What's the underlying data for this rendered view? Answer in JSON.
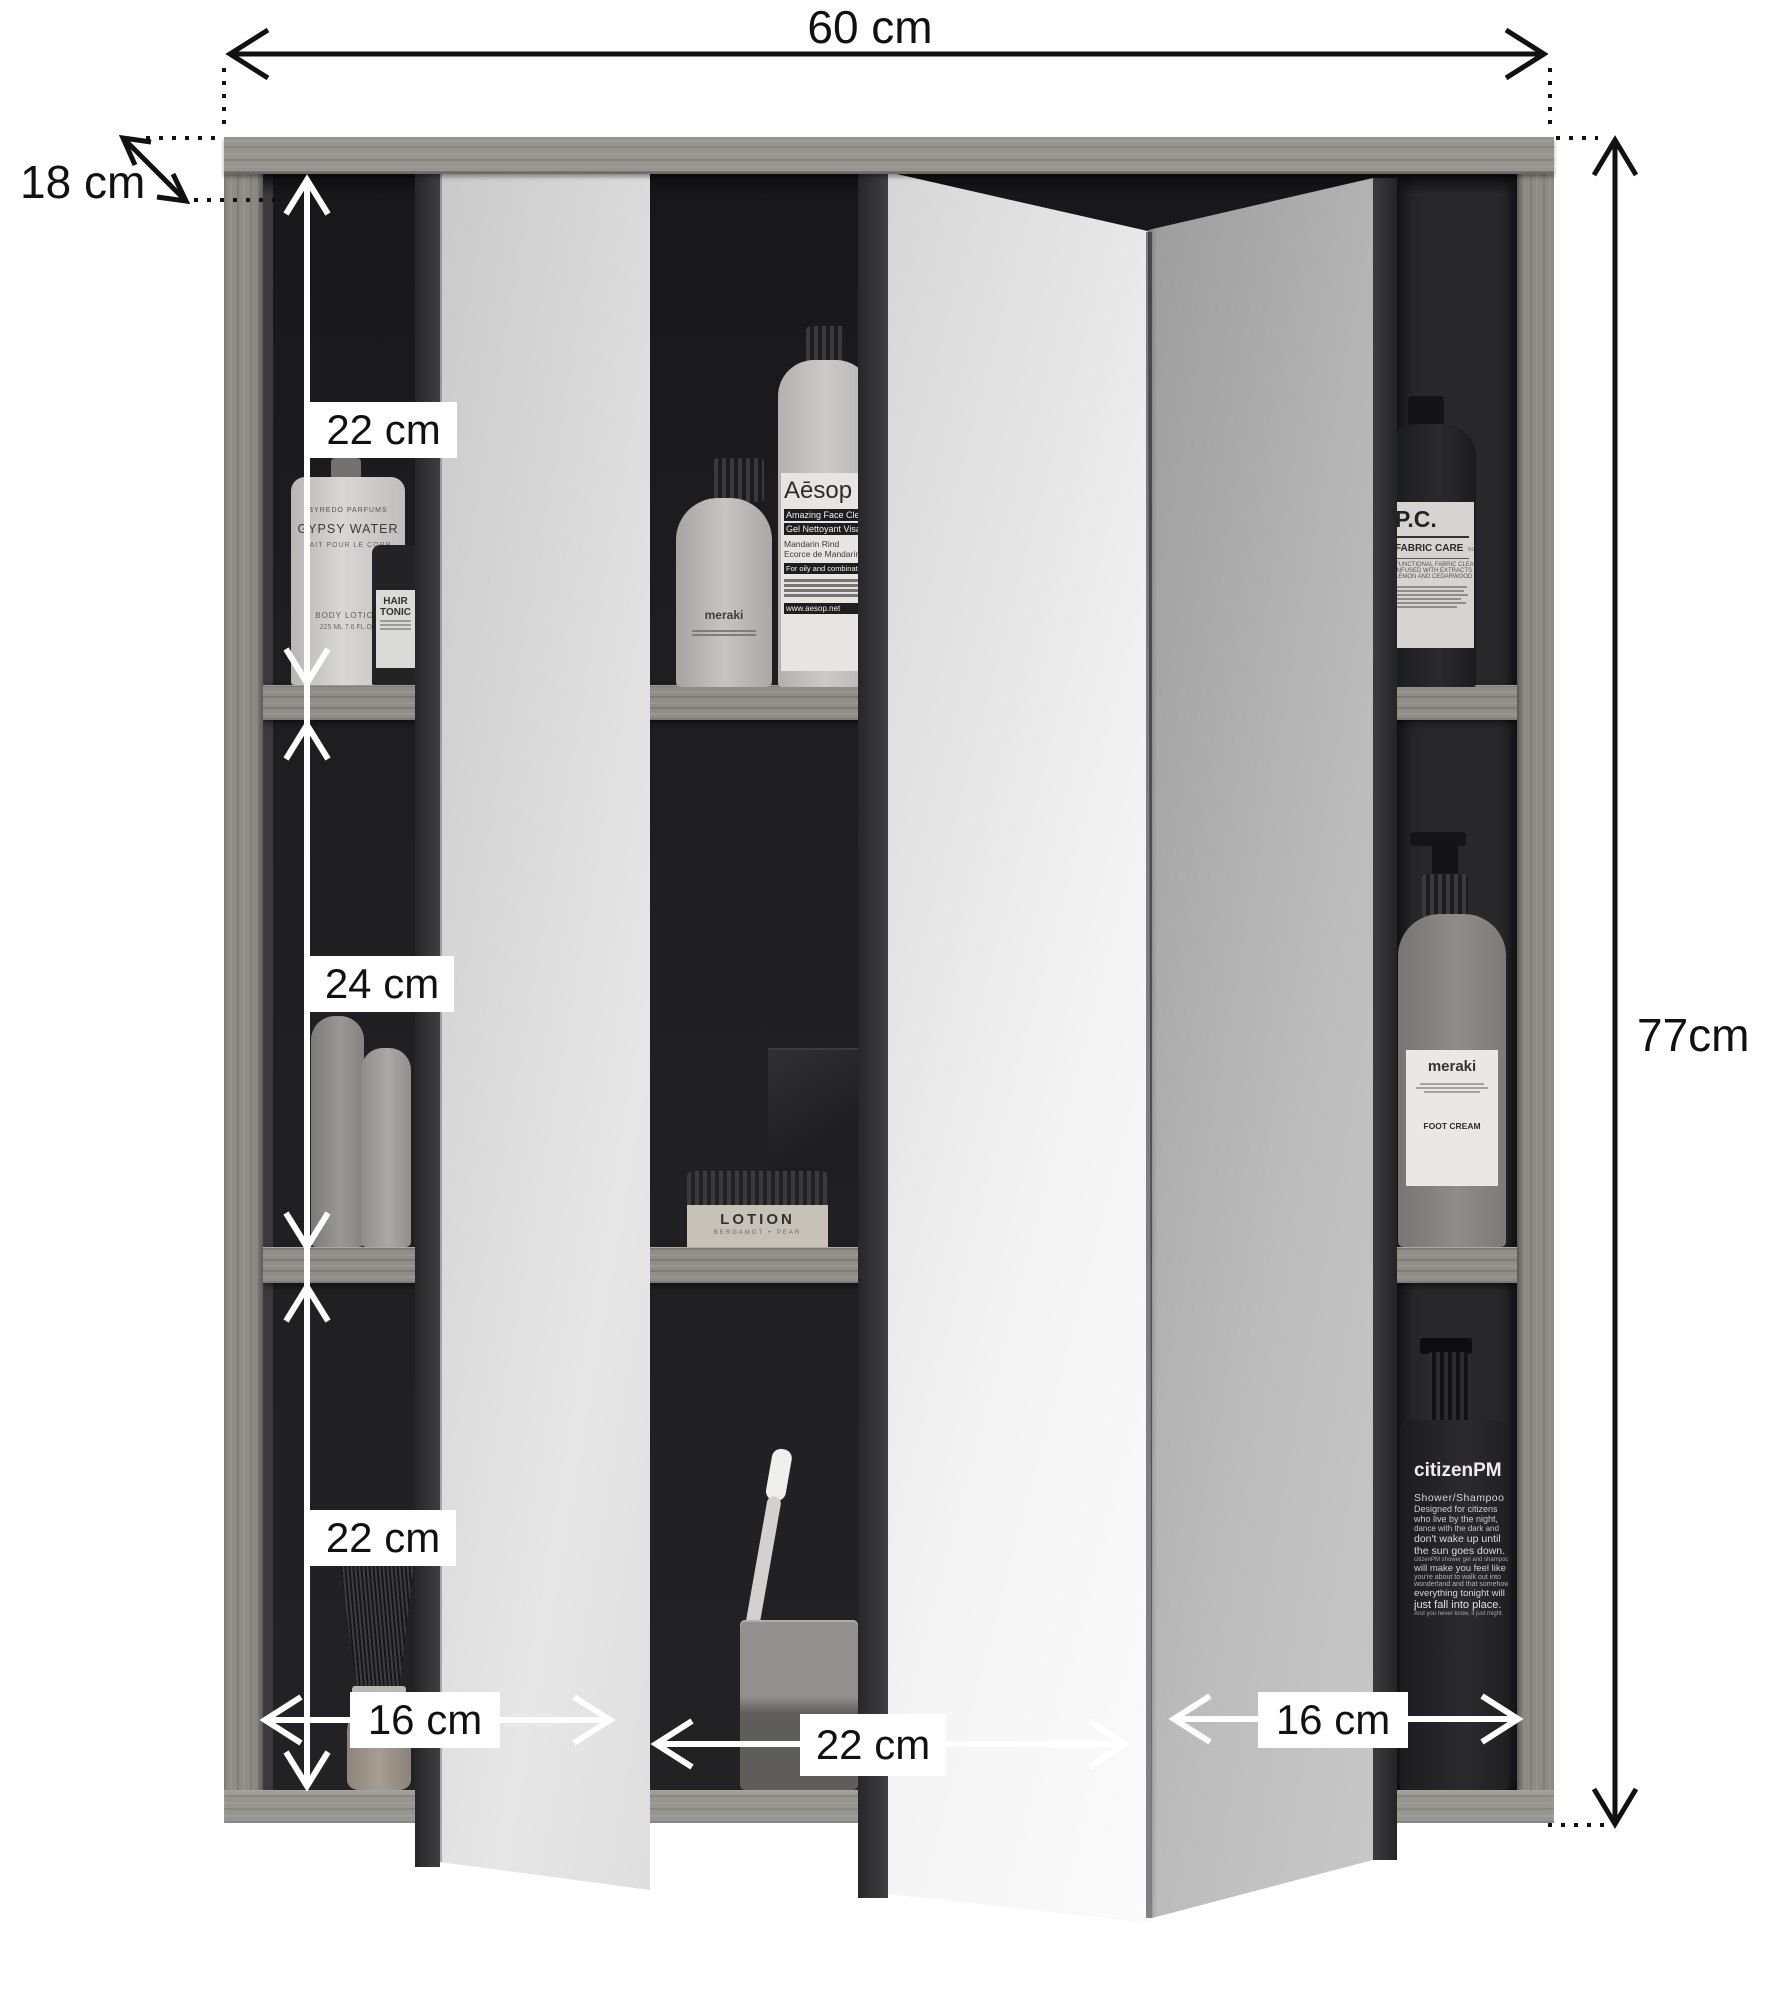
{
  "palette": {
    "wood": "#8e8d89",
    "interior_dark": "#1d1d1f",
    "mirror_light": "#ececec",
    "annotation_black": "#111111",
    "annotation_white": "#ffffff"
  },
  "dimensions": {
    "width": "60 cm",
    "depth": "18 cm",
    "height": "77cm",
    "shelf_heights": [
      "22 cm",
      "24 cm",
      "22 cm"
    ],
    "compartment_widths": [
      "16 cm",
      "22 cm",
      "16 cm"
    ]
  },
  "products": {
    "byredo": {
      "brand": "BYREDO PARFUMS",
      "name": "GYPSY WATER",
      "subtitle": "LAIT POUR LE CORP",
      "type": "BODY LOTION",
      "volume": "225 ML 7.6 FL.OZ"
    },
    "hair_tonic": {
      "line1": "HAIR",
      "line2": "TONIC"
    },
    "meraki_dropper": {
      "brand": "meraki"
    },
    "aesop": {
      "brand": "Aēsop",
      "lines": [
        "Amazing Face Cleanser",
        "Gel Nettoyant Visage",
        "Mandarin Rind",
        "Ecorce de Mandarine",
        "For oily and combination skin"
      ],
      "footer": "www.aesop.net"
    },
    "lotion": {
      "name": "LOTION",
      "subtitle": "BERGAMOT + PEAR"
    },
    "pc": {
      "brand": "P.C.",
      "category": "FABRIC CARE",
      "note": "NET WT 1 GAL",
      "lines": [
        "FUNCTIONAL FABRIC CLEANSER",
        "INFUSED WITH EXTRACTS OF",
        "LEMON AND CEDARWOOD"
      ]
    },
    "meraki_pump": {
      "brand": "meraki",
      "product": "FOOT CREAM"
    },
    "citizen": {
      "brand": "citizenPM",
      "category": "Shower/Shampoo",
      "lines": [
        "Designed for citizens",
        "who live by the night,",
        "dance with the dark and",
        "don't wake up until",
        "the sun goes down.",
        "citizenPM shower gel and shampoo",
        "will make you feel like",
        "you're about to walk out into",
        "wonderland and that somehow",
        "everything tonight will",
        "just fall into place.",
        "And you never know, it just might."
      ]
    }
  }
}
